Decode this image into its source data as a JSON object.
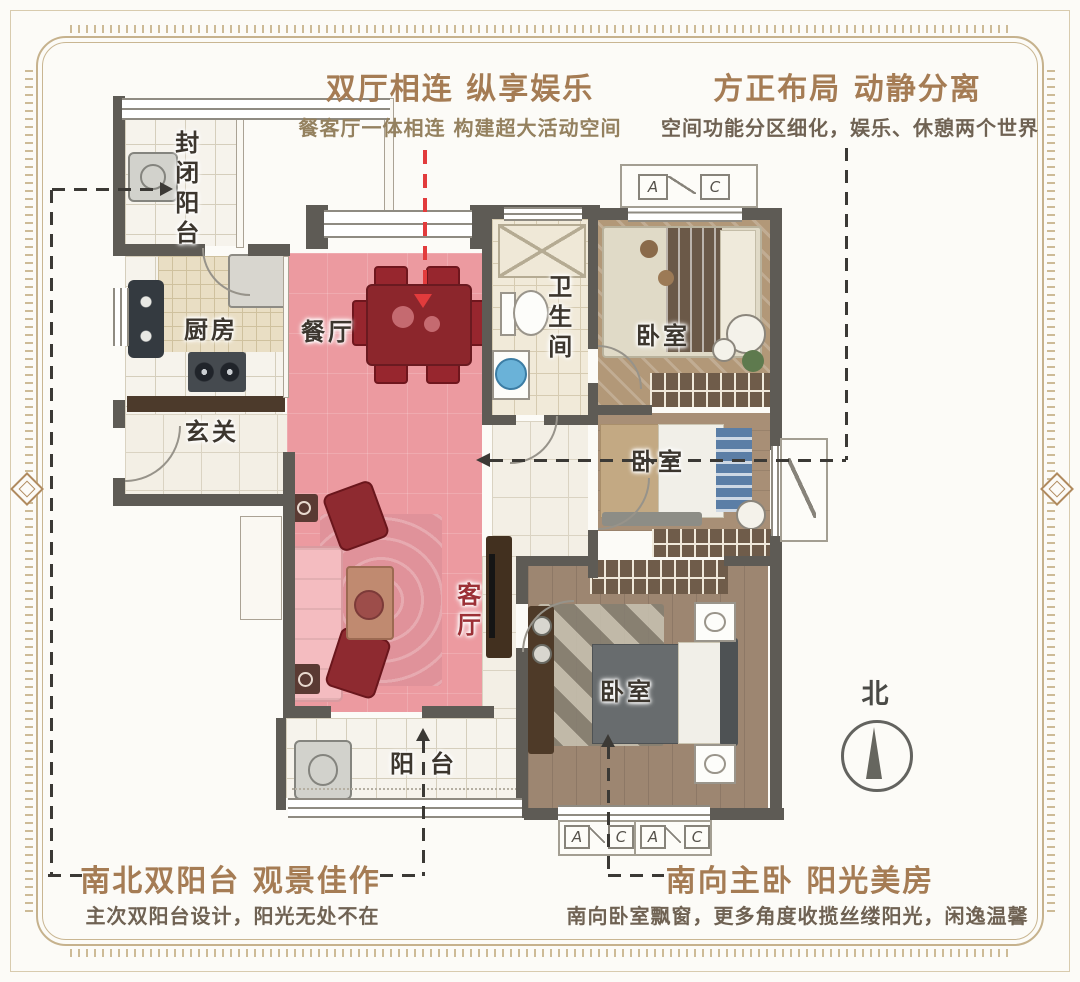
{
  "annotations": {
    "top_left": {
      "title": "双厅相连 纵享娱乐",
      "subtitle": "餐客厅一体相连 构建超大活动空间"
    },
    "top_right": {
      "title": "方正布局 动静分离",
      "subtitle": "空间功能分区细化，娱乐、休憩两个世界"
    },
    "bottom_left": {
      "title": "南北双阳台 观景佳作",
      "subtitle": "主次双阳台设计，阳光无处不在"
    },
    "bottom_right": {
      "title": "南向主卧 阳光美房",
      "subtitle": "南向卧室飘窗，更多角度收揽丝缕阳光，闲逸温馨"
    }
  },
  "rooms": {
    "north_balcony": "封闭阳台",
    "kitchen": "厨房",
    "entry": "玄关",
    "dining": "餐厅",
    "living": "客厅",
    "bathroom": "卫生间",
    "bedroom_top": "卧室",
    "bedroom_mid": "卧室",
    "bedroom_master": "卧室",
    "south_balcony": "阳台"
  },
  "compass": {
    "north_label": "北"
  },
  "marks": {
    "a": "A",
    "c": "C"
  },
  "colors": {
    "title_brown": "#a57c54",
    "subtitle_gray": "#6f6253",
    "highlight_pink": "#ec9aa0",
    "furniture_red": "#8e2a30",
    "arrow_red": "#e23b3c",
    "dash_dark": "#3b3935",
    "wall_gray": "#5e5b55",
    "label_dark": "#3c362e",
    "living_label_red": "#9c3036"
  }
}
